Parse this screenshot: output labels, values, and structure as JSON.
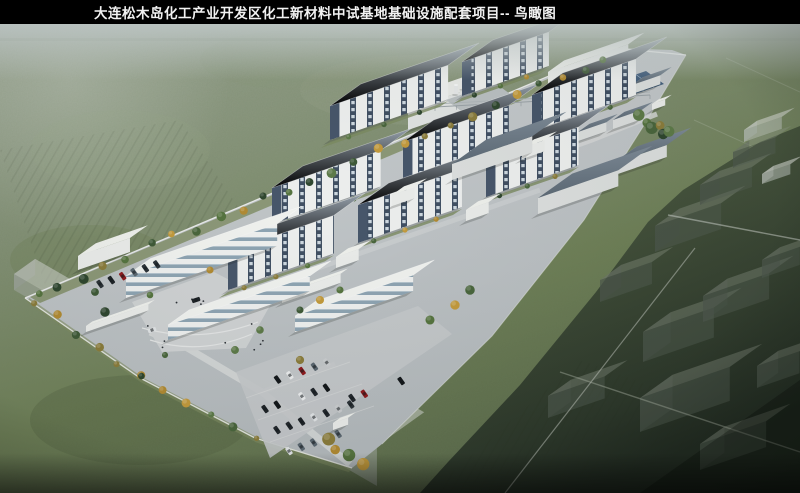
{
  "title_bar": {
    "text": "大连松木岛化工产业开发区化工新材料中试基地基础设施配套项目-- 鸟瞰图",
    "background": "#000000",
    "text_color": "#f2f2f2"
  },
  "scene": {
    "type": "architectural-aerial-rendering",
    "view_label": "鸟瞰图",
    "elements": {
      "farmland": "green-farmland",
      "campus": "chemical-pilot-test-campus",
      "pilot_buildings": "multi-story-pilot-plant-buildings",
      "warehouses": "warehouse-and-utility-sheds",
      "tank_farm": "tank-farm",
      "stack": "exhaust-stack",
      "solar_array": "solar-panel-array",
      "offices": "office-buildings",
      "plaza": "entrance-plaza",
      "parking": "parking-lots",
      "road": "arterial-road-with-traffic",
      "tree_belts": "roadside-tree-belts",
      "ghost_buildings": "planned-future-buildings",
      "gates": "campus-gates"
    },
    "palette": {
      "haze": "#c3cccb",
      "field_light": "#a2ac9c",
      "field_mid": "#7c8a62",
      "field_dark": "#59684a",
      "dark_zone": "#2a342a",
      "road": "#8d959d",
      "campus_ground": "#c2c6c8",
      "building_wall": "#eceeed",
      "window_strip": "#435262",
      "shed_roof": "#6c7a88",
      "tree_green": "#4a6540",
      "tree_autumn": "#b8913c"
    }
  }
}
